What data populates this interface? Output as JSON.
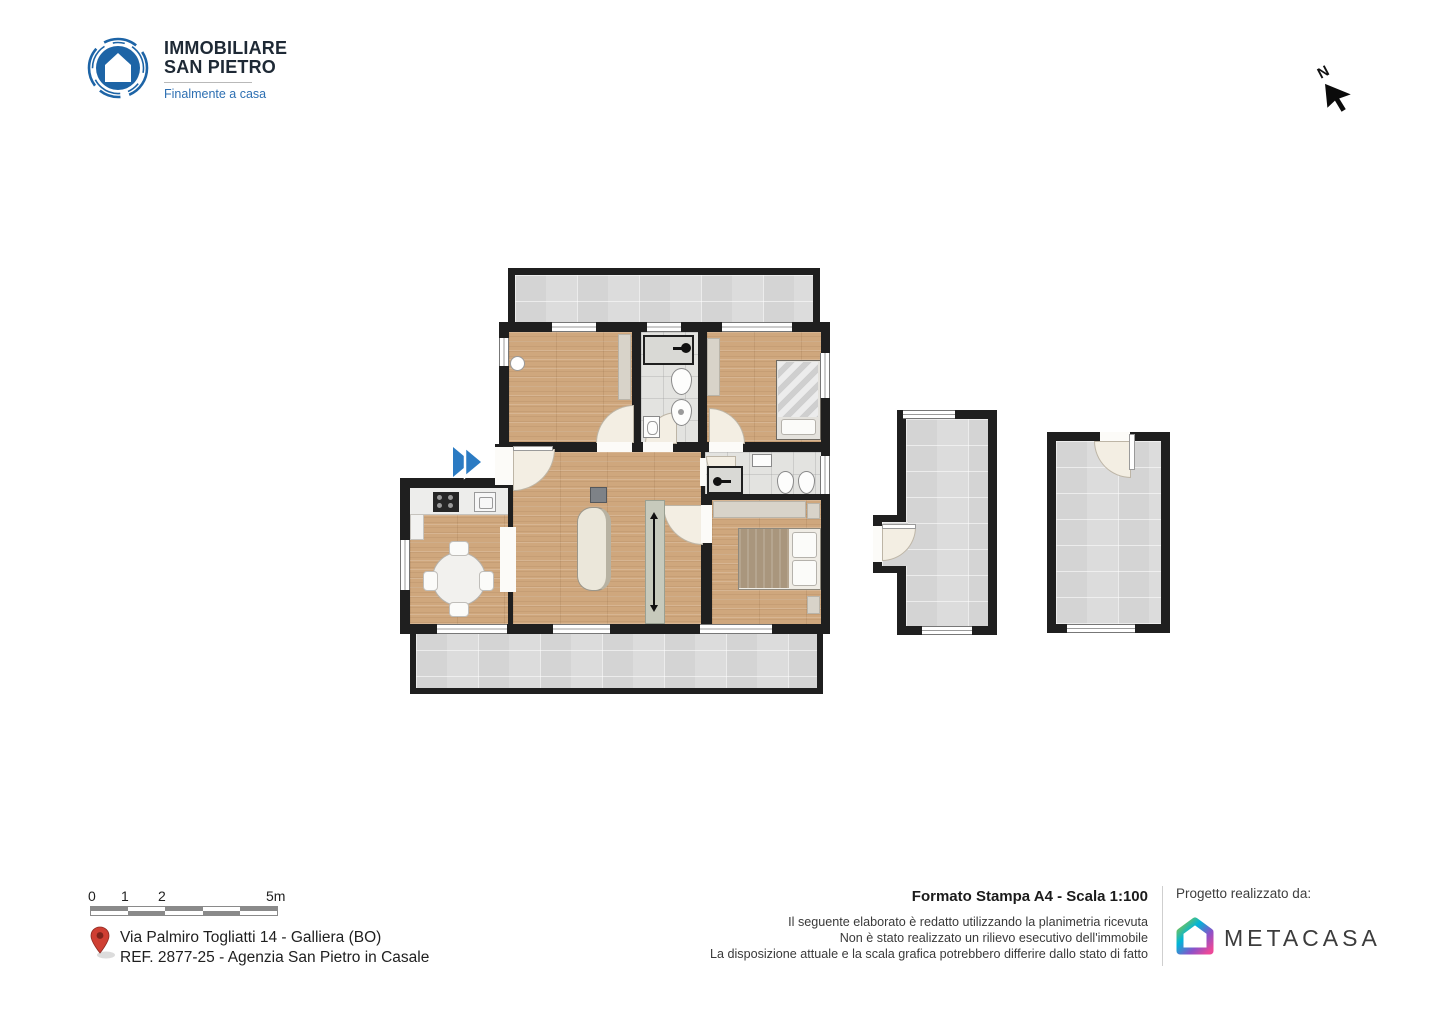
{
  "header": {
    "logo": {
      "line1": "IMMOBILIARE",
      "line2": "SAN PIETRO",
      "tagline": "Finalmente a casa",
      "circle_color": "#1d64a6",
      "text_color": "#1e2935",
      "tagline_color": "#2d6fb2"
    },
    "north": {
      "label": "N"
    }
  },
  "plan": {
    "colors": {
      "wall": "#1f1f1f",
      "wood_floor": "#cfa77d",
      "terrace_tile": "#dcdcdc",
      "bath_tile": "#e3e3e0",
      "door_arc": "#f3eee3",
      "furniture_beige": "#d8d3c9",
      "bed_blanket": "#a9967d",
      "entrance_arrow_blue": "#2b7bc3"
    }
  },
  "footer": {
    "scale_bar": {
      "ticks": {
        "t0": "0",
        "t1": "1",
        "t2": "2",
        "t3": "5m"
      }
    },
    "address_line1": "Via Palmiro Togliatti 14 - Galliera (BO)",
    "address_line2": "REF. 2877-25 - Agenzia San Pietro in Casale",
    "print_info": "Formato Stampa A4 - Scala 1:100",
    "disclaimer_line1": "Il seguente elaborato è redatto utilizzando la planimetria ricevuta",
    "disclaimer_line2": "Non è stato realizzato un rilievo esecutivo dell'immobile",
    "disclaimer_line3": "La disposizione attuale e la scala grafica potrebbero differire dallo stato di fatto",
    "credit_label": "Progetto realizzato da:",
    "credit_brand": "METACASA",
    "pin_color": "#cf3f33"
  }
}
